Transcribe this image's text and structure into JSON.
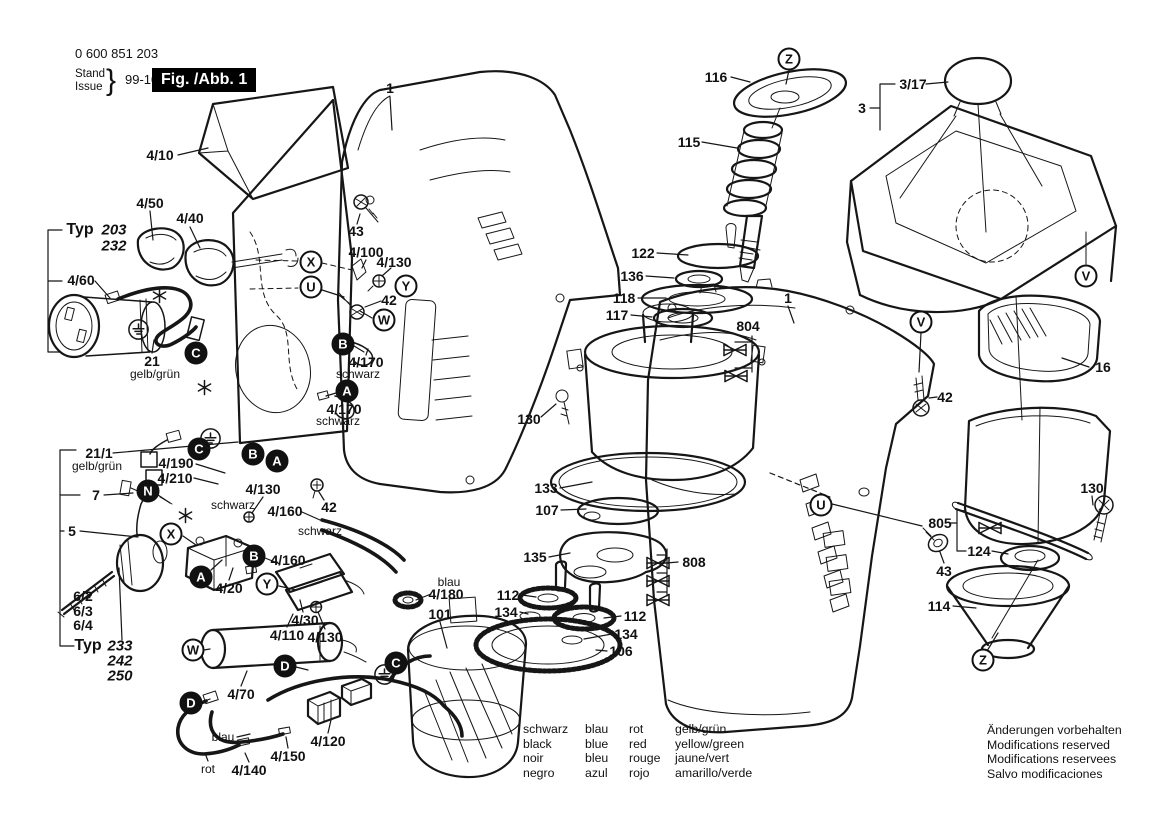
{
  "header": {
    "part_number": "0 600 851 203",
    "stand_label": "Stand",
    "issue_label": "Issue",
    "brace": "}",
    "date": "99-10-07",
    "figure_label": "Fig. /Abb. 1"
  },
  "legend": {
    "rows": [
      [
        "schwarz",
        "blau",
        "rot",
        "gelb/grün"
      ],
      [
        "black",
        "blue",
        "red",
        "yellow/green"
      ],
      [
        "noir",
        "bleu",
        "rouge",
        "jaune/vert"
      ],
      [
        "negro",
        "azul",
        "rojo",
        "amarillo/verde"
      ]
    ]
  },
  "footer": {
    "lines": [
      "Änderungen vorbehalten",
      "Modifications reserved",
      "Modifications reservees",
      "Salvo modificaciones"
    ]
  },
  "diagram": {
    "callouts": [
      {
        "t": "4/10",
        "x": 160,
        "y": 155
      },
      {
        "t": "1",
        "x": 390,
        "y": 88
      },
      {
        "t": "4/50",
        "x": 150,
        "y": 203
      },
      {
        "t": "4/40",
        "x": 190,
        "y": 218
      },
      {
        "t": "Typ",
        "x": 80,
        "y": 230,
        "s": "typ"
      },
      {
        "t": "203",
        "x": 114,
        "y": 230,
        "s": "it"
      },
      {
        "t": "232",
        "x": 114,
        "y": 246,
        "s": "it"
      },
      {
        "t": "4/60",
        "x": 81,
        "y": 280
      },
      {
        "t": "21",
        "x": 152,
        "y": 361
      },
      {
        "t": "gelb/grün",
        "x": 155,
        "y": 374,
        "s": "sm"
      },
      {
        "t": "43",
        "x": 356,
        "y": 231
      },
      {
        "t": "4/100",
        "x": 366,
        "y": 252
      },
      {
        "t": "4/130",
        "x": 394,
        "y": 262
      },
      {
        "t": "42",
        "x": 389,
        "y": 300
      },
      {
        "t": "4/170",
        "x": 366,
        "y": 362
      },
      {
        "t": "schwarz",
        "x": 358,
        "y": 374,
        "s": "sm"
      },
      {
        "t": "4/170",
        "x": 344,
        "y": 409
      },
      {
        "t": "schwarz",
        "x": 338,
        "y": 421,
        "s": "sm"
      },
      {
        "t": "21/1",
        "x": 99,
        "y": 453
      },
      {
        "t": "gelb/grün",
        "x": 97,
        "y": 466,
        "s": "sm"
      },
      {
        "t": "4/190",
        "x": 176,
        "y": 463
      },
      {
        "t": "4/210",
        "x": 175,
        "y": 478
      },
      {
        "t": "7",
        "x": 96,
        "y": 495
      },
      {
        "t": "4/130",
        "x": 263,
        "y": 489
      },
      {
        "t": "schwarz",
        "x": 233,
        "y": 505,
        "s": "sm"
      },
      {
        "t": "4/160",
        "x": 285,
        "y": 511
      },
      {
        "t": "42",
        "x": 329,
        "y": 507
      },
      {
        "t": "schwarz",
        "x": 320,
        "y": 531,
        "s": "sm"
      },
      {
        "t": "5",
        "x": 72,
        "y": 531
      },
      {
        "t": "4/160",
        "x": 288,
        "y": 560
      },
      {
        "t": "4/20",
        "x": 229,
        "y": 588
      },
      {
        "t": "6/2",
        "x": 83,
        "y": 596
      },
      {
        "t": "6/3",
        "x": 83,
        "y": 611
      },
      {
        "t": "6/4",
        "x": 83,
        "y": 625
      },
      {
        "t": "Typ",
        "x": 88,
        "y": 646,
        "s": "typ"
      },
      {
        "t": "233",
        "x": 120,
        "y": 646,
        "s": "it"
      },
      {
        "t": "242",
        "x": 120,
        "y": 661,
        "s": "it"
      },
      {
        "t": "250",
        "x": 120,
        "y": 676,
        "s": "it"
      },
      {
        "t": "4/30",
        "x": 305,
        "y": 620
      },
      {
        "t": "4/110",
        "x": 287,
        "y": 635
      },
      {
        "t": "4/130",
        "x": 325,
        "y": 637
      },
      {
        "t": "4/70",
        "x": 241,
        "y": 694
      },
      {
        "t": "blau",
        "x": 223,
        "y": 737,
        "s": "sm"
      },
      {
        "t": "4/120",
        "x": 328,
        "y": 741
      },
      {
        "t": "4/150",
        "x": 288,
        "y": 756
      },
      {
        "t": "rot",
        "x": 208,
        "y": 769,
        "s": "sm"
      },
      {
        "t": "4/140",
        "x": 249,
        "y": 770
      },
      {
        "t": "blau",
        "x": 449,
        "y": 582,
        "s": "sm"
      },
      {
        "t": "4/180",
        "x": 446,
        "y": 594
      },
      {
        "t": "101",
        "x": 440,
        "y": 614
      },
      {
        "t": "116",
        "x": 716,
        "y": 77
      },
      {
        "t": "115",
        "x": 689,
        "y": 142
      },
      {
        "t": "1",
        "x": 788,
        "y": 298
      },
      {
        "t": "122",
        "x": 643,
        "y": 253
      },
      {
        "t": "136",
        "x": 632,
        "y": 276
      },
      {
        "t": "118",
        "x": 624,
        "y": 298
      },
      {
        "t": "117",
        "x": 617,
        "y": 315
      },
      {
        "t": "804",
        "x": 748,
        "y": 326
      },
      {
        "t": "130",
        "x": 529,
        "y": 419
      },
      {
        "t": "133",
        "x": 546,
        "y": 488
      },
      {
        "t": "107",
        "x": 547,
        "y": 510
      },
      {
        "t": "135",
        "x": 535,
        "y": 557
      },
      {
        "t": "808",
        "x": 694,
        "y": 562
      },
      {
        "t": "112",
        "x": 508,
        "y": 595
      },
      {
        "t": "134",
        "x": 506,
        "y": 612
      },
      {
        "t": "112",
        "x": 635,
        "y": 616
      },
      {
        "t": "134",
        "x": 626,
        "y": 634
      },
      {
        "t": "106",
        "x": 621,
        "y": 651
      },
      {
        "t": "3/17",
        "x": 913,
        "y": 84
      },
      {
        "t": "3",
        "x": 862,
        "y": 108
      },
      {
        "t": "42",
        "x": 945,
        "y": 397
      },
      {
        "t": "16",
        "x": 1103,
        "y": 367
      },
      {
        "t": "130",
        "x": 1092,
        "y": 488
      },
      {
        "t": "805",
        "x": 940,
        "y": 523
      },
      {
        "t": "124",
        "x": 979,
        "y": 551
      },
      {
        "t": "43",
        "x": 944,
        "y": 571
      },
      {
        "t": "114",
        "x": 939,
        "y": 606
      }
    ],
    "markers": [
      {
        "l": "Z",
        "x": 789,
        "y": 59
      },
      {
        "l": "X",
        "x": 311,
        "y": 262
      },
      {
        "l": "U",
        "x": 311,
        "y": 287
      },
      {
        "l": "Y",
        "x": 406,
        "y": 286
      },
      {
        "l": "W",
        "x": 384,
        "y": 320
      },
      {
        "l": "C",
        "x": 196,
        "y": 353,
        "f": 1
      },
      {
        "l": "B",
        "x": 343,
        "y": 344,
        "f": 1
      },
      {
        "l": "A",
        "x": 347,
        "y": 391,
        "f": 1
      },
      {
        "l": "C",
        "x": 199,
        "y": 449,
        "f": 1
      },
      {
        "l": "B",
        "x": 253,
        "y": 454,
        "f": 1
      },
      {
        "l": "A",
        "x": 277,
        "y": 461,
        "f": 1
      },
      {
        "l": "N",
        "x": 148,
        "y": 491,
        "f": 1
      },
      {
        "l": "X",
        "x": 171,
        "y": 534
      },
      {
        "l": "B",
        "x": 254,
        "y": 556,
        "f": 1
      },
      {
        "l": "A",
        "x": 201,
        "y": 577,
        "f": 1
      },
      {
        "l": "Y",
        "x": 267,
        "y": 584
      },
      {
        "l": "W",
        "x": 193,
        "y": 650
      },
      {
        "l": "D",
        "x": 285,
        "y": 666,
        "f": 1
      },
      {
        "l": "C",
        "x": 396,
        "y": 663,
        "f": 1
      },
      {
        "l": "D",
        "x": 191,
        "y": 703,
        "f": 1
      },
      {
        "l": "V",
        "x": 921,
        "y": 322
      },
      {
        "l": "V",
        "x": 1086,
        "y": 276
      },
      {
        "l": "U",
        "x": 821,
        "y": 505
      },
      {
        "l": "Z",
        "x": 983,
        "y": 660
      }
    ],
    "symbols": [
      {
        "k": "earth",
        "x": 127,
        "y": 318
      },
      {
        "k": "earth",
        "x": 199,
        "y": 427
      },
      {
        "k": "earth",
        "x": 373,
        "y": 663
      },
      {
        "k": "star",
        "x": 151,
        "y": 287
      },
      {
        "k": "star",
        "x": 196,
        "y": 379
      },
      {
        "k": "star",
        "x": 177,
        "y": 507
      },
      {
        "k": "xbearing",
        "x": 722,
        "y": 342
      },
      {
        "k": "xbearing",
        "x": 723,
        "y": 368
      },
      {
        "k": "xbearing",
        "x": 645,
        "y": 555
      },
      {
        "k": "xbearing",
        "x": 645,
        "y": 573
      },
      {
        "k": "xbearing",
        "x": 645,
        "y": 592
      },
      {
        "k": "xbearing",
        "x": 977,
        "y": 520
      }
    ]
  }
}
